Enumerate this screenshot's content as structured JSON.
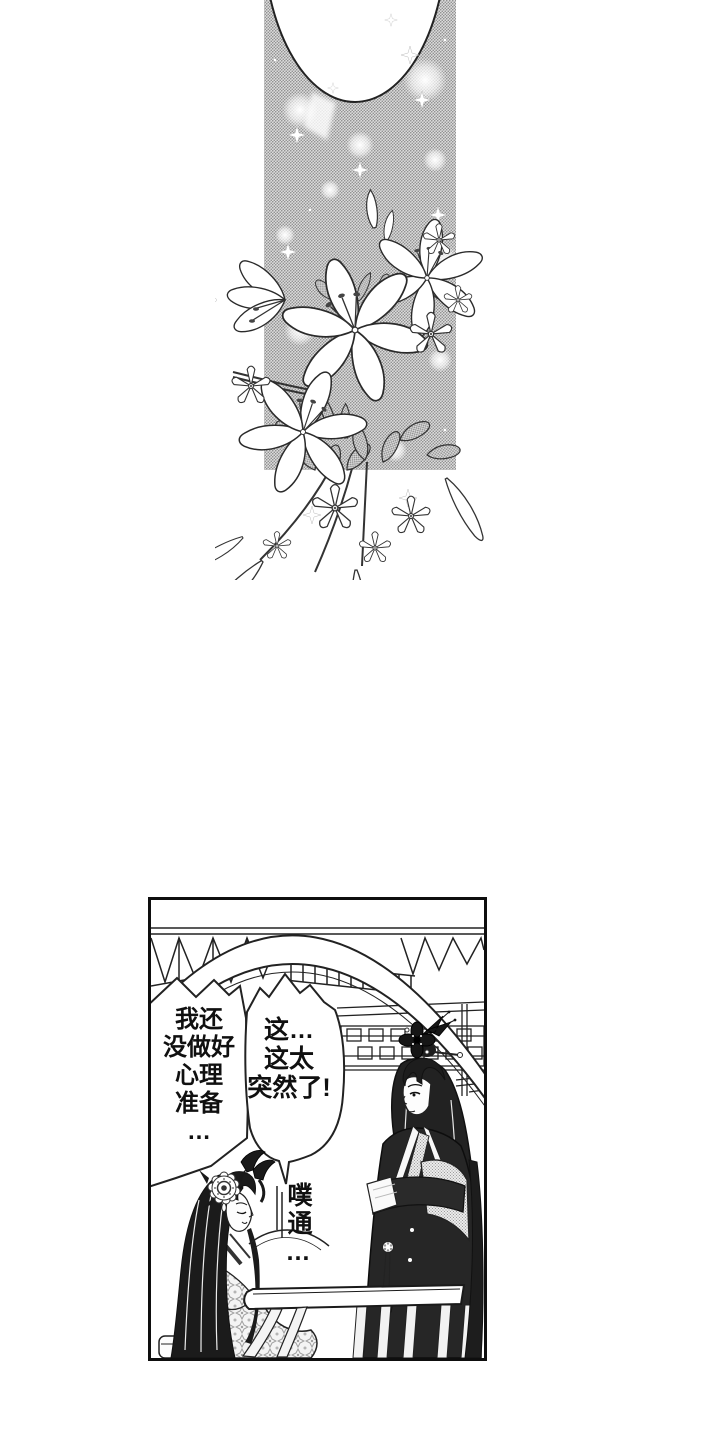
{
  "colors": {
    "paper": "#ffffff",
    "ink": "#1a1a1a",
    "screentone_gray": "#c9c9c9",
    "panel_border": "#0e0e0e"
  },
  "top_panel": {
    "elements": [
      "blank-oval-speech-balloon",
      "sparkling-screentone-sky",
      "lily-bouquet"
    ]
  },
  "bottom_panel": {
    "bubble_left": {
      "lines": [
        "我还",
        "没做好",
        "心理",
        "准备",
        "…"
      ]
    },
    "bubble_right": {
      "lines": [
        "这…",
        "这太",
        "突然了!"
      ]
    },
    "sfx": {
      "text": "噗通…"
    },
    "elements": [
      "garden-arch-bridge",
      "roof-truss",
      "lattice-frieze",
      "standing-man-arms-crossed",
      "seated-woman-head-bowed",
      "table",
      "stool"
    ]
  }
}
